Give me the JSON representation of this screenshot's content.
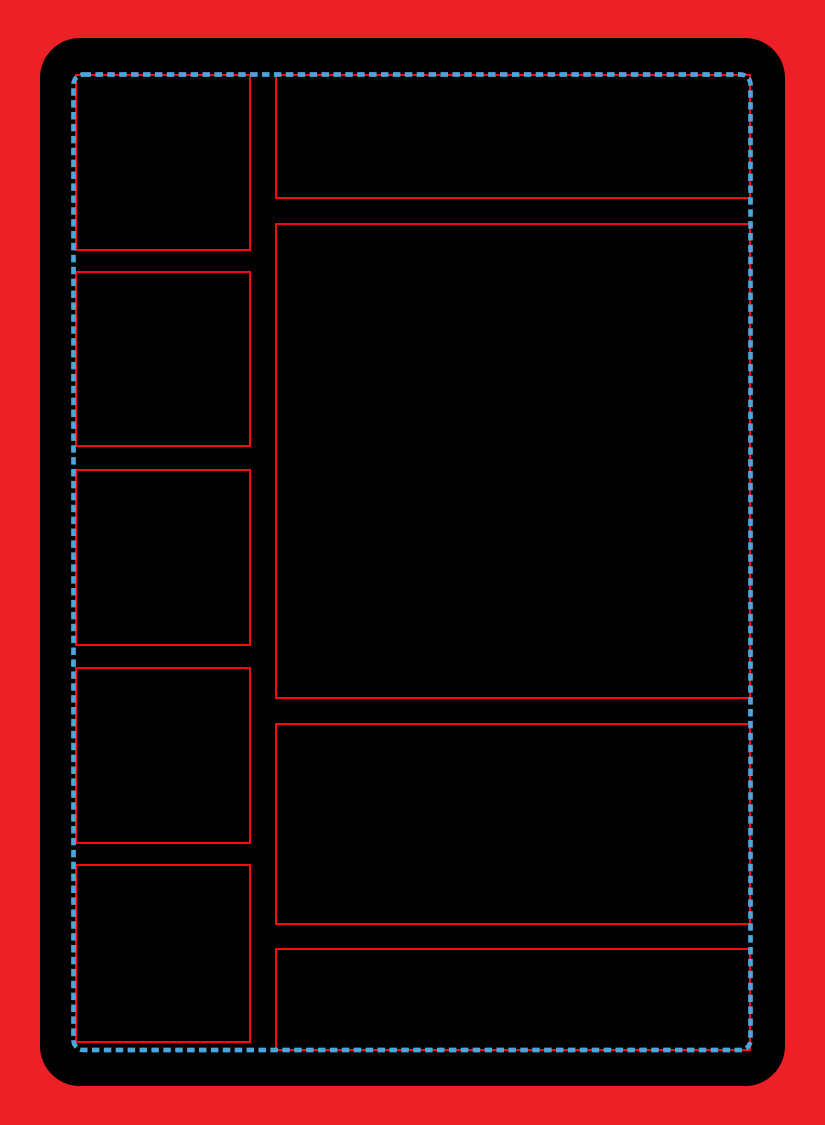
{
  "template": {
    "name": "card-frame-layout-template",
    "canvas": {
      "width": 825,
      "height": 1125
    },
    "colors": {
      "background_red": "#EC2127",
      "card_black": "#000000",
      "panel_outline_red": "#FA0A0F",
      "safe_area_dash_blue": "#4BA6DB"
    },
    "card": {
      "x": 40,
      "y": 38,
      "width": 745,
      "height": 1048,
      "corner_radius": 40
    },
    "safe_area": {
      "x": 73.5,
      "y": 74.5,
      "width": 677,
      "height": 975.5,
      "corner_radius": 10,
      "stroke_width": 4.7,
      "dash_length": 7.5,
      "dash_gap": 4.4
    },
    "panel_outline_width": 2.4,
    "panels": [
      {
        "id": "left-slot-1",
        "x": 75,
        "y": 74,
        "width": 176,
        "height": 177
      },
      {
        "id": "left-slot-2",
        "x": 75,
        "y": 271,
        "width": 176,
        "height": 176
      },
      {
        "id": "left-slot-3",
        "x": 75,
        "y": 469,
        "width": 176,
        "height": 177
      },
      {
        "id": "left-slot-4",
        "x": 75,
        "y": 667,
        "width": 176,
        "height": 177
      },
      {
        "id": "left-slot-5",
        "x": 75,
        "y": 864,
        "width": 176,
        "height": 179
      },
      {
        "id": "right-header",
        "x": 275,
        "y": 74,
        "width": 476,
        "height": 125
      },
      {
        "id": "right-main-art",
        "x": 275,
        "y": 223,
        "width": 476,
        "height": 476
      },
      {
        "id": "right-text-box",
        "x": 275,
        "y": 723,
        "width": 476,
        "height": 202
      },
      {
        "id": "right-bottom-strip",
        "x": 275,
        "y": 948,
        "width": 476,
        "height": 103
      }
    ]
  }
}
